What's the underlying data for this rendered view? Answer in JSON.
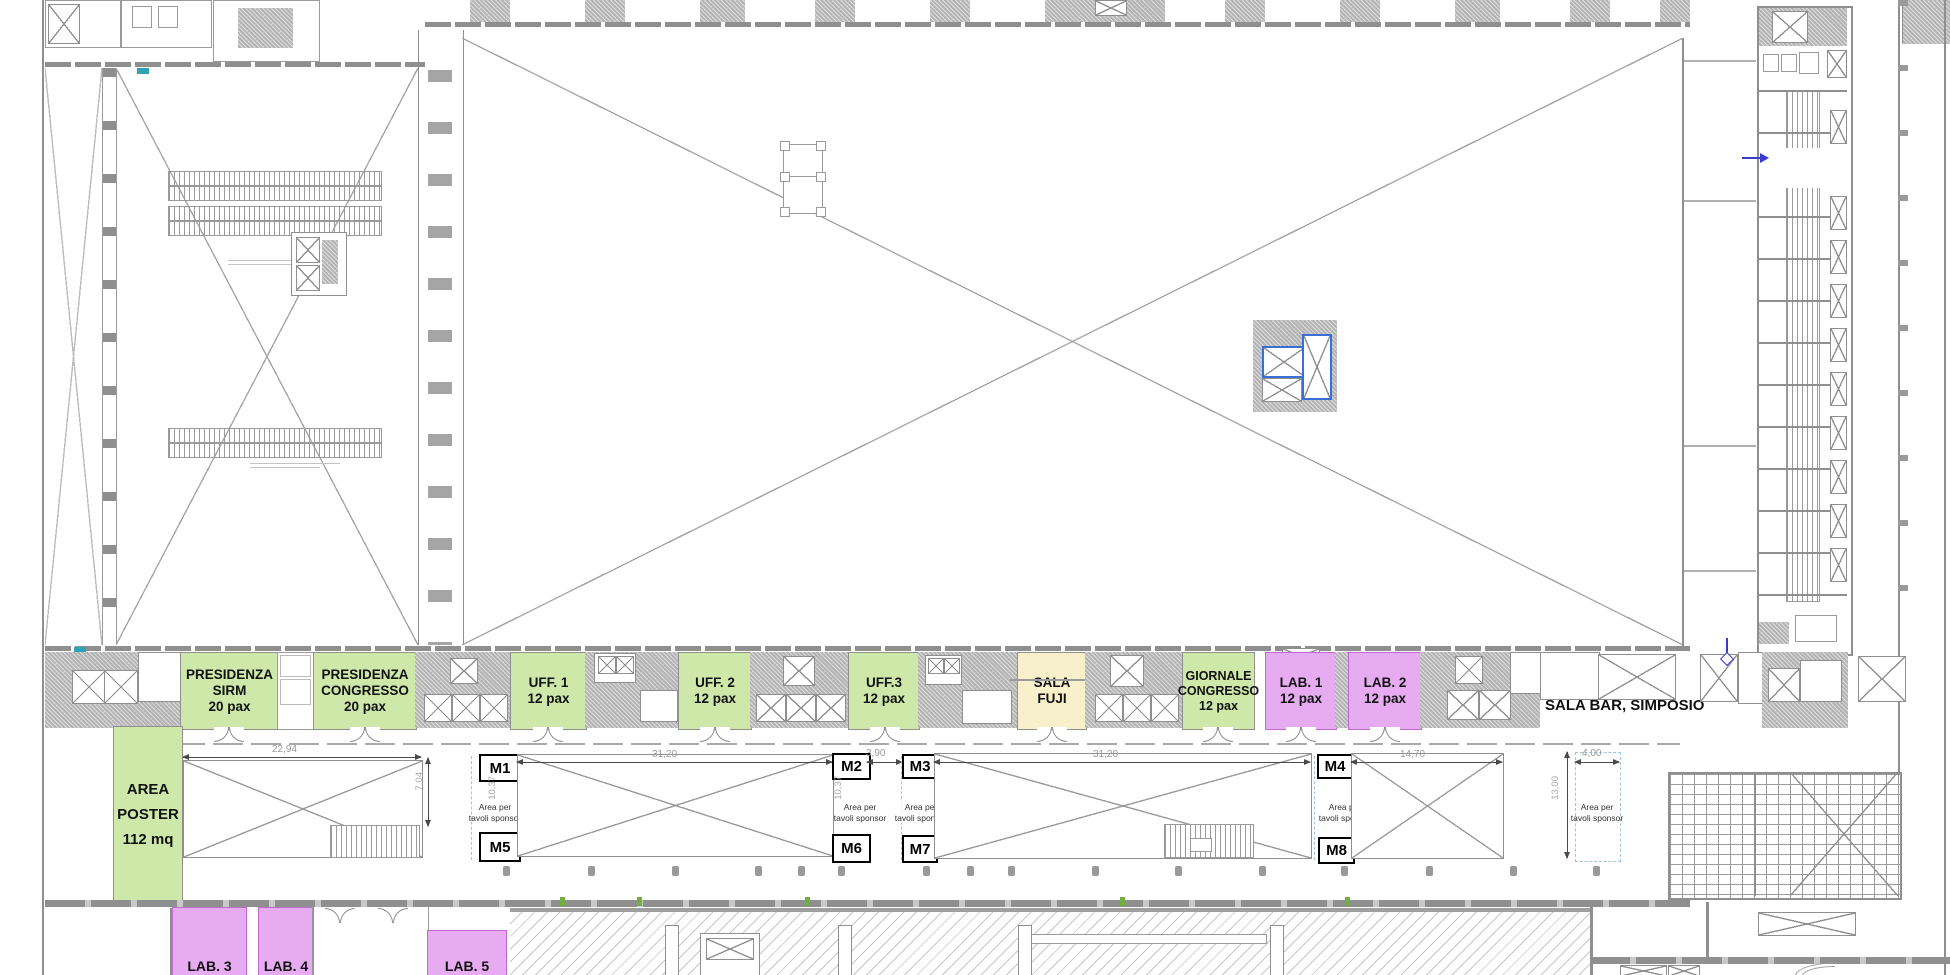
{
  "plan": {
    "rooms": [
      {
        "line1": "PRESIDENZA",
        "line2": "SIRM",
        "capacity": "20 pax"
      },
      {
        "line1": "PRESIDENZA",
        "line2": "CONGRESSO",
        "capacity": "20 pax"
      },
      {
        "line1": "UFF. 1",
        "line2": "",
        "capacity": "12 pax"
      },
      {
        "line1": "UFF. 2",
        "line2": "",
        "capacity": "12 pax"
      },
      {
        "line1": "UFF.3",
        "line2": "",
        "capacity": "12 pax"
      },
      {
        "line1": "SALA",
        "line2": "FUJI",
        "capacity": ""
      },
      {
        "line1": "GIORNALE",
        "line2": "CONGRESSO",
        "capacity": "12 pax"
      },
      {
        "line1": "LAB. 1",
        "line2": "",
        "capacity": "12 pax"
      },
      {
        "line1": "LAB. 2",
        "line2": "",
        "capacity": "12 pax"
      }
    ],
    "corridor_label": "SALA BAR, SIMPOSIO",
    "poster_area": {
      "line1": "AREA",
      "line2": "POSTER",
      "line3": "112 mq"
    },
    "labs_bottom": [
      "LAB. 3",
      "LAB. 4",
      "LAB. 5"
    ],
    "markers": [
      "M1",
      "M2",
      "M3",
      "M4",
      "M5",
      "M6",
      "M7",
      "M8"
    ],
    "dimensions": {
      "r1_width": "22,94",
      "r1_height": "7,04",
      "r2_width": "31,20",
      "depth_a": "10,37",
      "gap_m2_m3": "3,90",
      "r3_width": "31,20",
      "depth_b": "10,37",
      "r4_width": "14,70",
      "bar_width": "4,00",
      "bar_height": "13,00"
    },
    "sponsor_label": {
      "line1": "Area per",
      "line2": "tavoli sponsor"
    },
    "colors": {
      "room_green": "#cde8a9",
      "room_yellow": "#f7f0ca",
      "room_purple": "#e7abf2",
      "selection_blue": "#3a6fd8",
      "marker_blue": "#3a3ad0",
      "teal_mark": "#2fa3b5",
      "tick_green": "#6fae3f",
      "wall_gray": "#8f8f8f"
    }
  }
}
